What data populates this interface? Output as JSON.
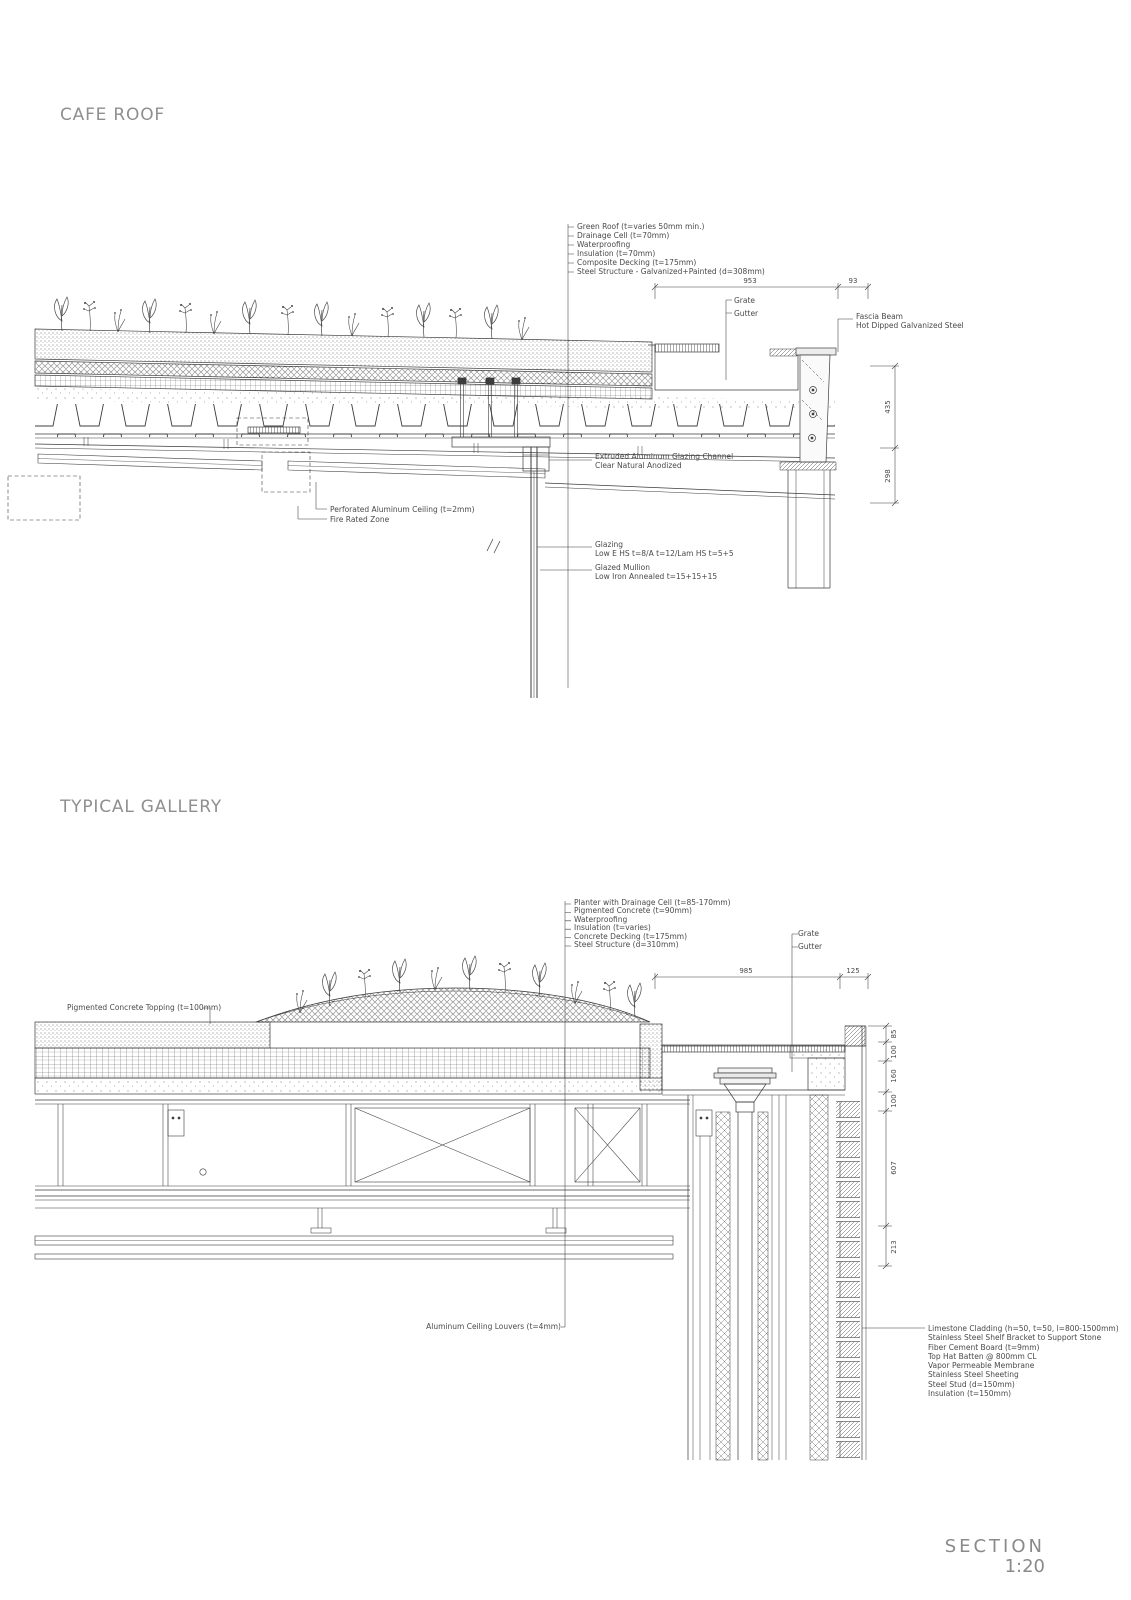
{
  "page": {
    "cafe_title": "CAFE ROOF",
    "gallery_title": "TYPICAL GALLERY",
    "section_label": "SECTION",
    "scale_label": "1:20"
  },
  "cafe_roof": {
    "layer_callouts": [
      "Green Roof (t=varies 50mm min.)",
      "Drainage Cell (t=70mm)",
      "Waterproofing",
      "Insulation (t=70mm)",
      "Composite Decking (t=175mm)",
      "Steel Structure - Galvanized+Painted (d=308mm)"
    ],
    "grate_label": "Grate",
    "gutter_label": "Gutter",
    "fascia_label_1": "Fascia Beam",
    "fascia_label_2": "Hot Dipped Galvanized Steel",
    "glazing_channel_1": "Extruded Aluminum Glazing Channel",
    "glazing_channel_2": "Clear Natural Anodized",
    "perforated_ceiling_label": "Perforated Aluminum Ceiling (t=2mm)",
    "fire_rated_label": "Fire Rated Zone",
    "glazing_1": "Glazing",
    "glazing_2": "Low E HS t=8/A t=12/Lam HS t=5+5",
    "mullion_1": "Glazed Mullion",
    "mullion_2": "Low Iron Annealed t=15+15+15",
    "dims": {
      "gutter_width": "953",
      "edge": "93",
      "upper_height": "435",
      "lower_height": "298"
    }
  },
  "typical_gallery": {
    "layer_callouts": [
      "Planter with Drainage Cell (t=85-170mm)",
      "Pigmented Concrete (t=90mm)",
      "Waterproofing",
      "Insulation (t=varies)",
      "Concrete Decking (t=175mm)",
      "Steel Structure (d=310mm)"
    ],
    "topping_label": "Pigmented Concrete Topping (t=100mm)",
    "grate_label": "Grate",
    "gutter_label": "Gutter",
    "louvers_label": "Aluminum Ceiling Louvers (t=4mm)",
    "wall_callouts": [
      "Limestone Cladding (h=50, t=50, l=800-1500mm)",
      "Stainless Steel Shelf Bracket to Support Stone",
      "Fiber Cement Board (t=9mm)",
      "Top Hat Batten @ 800mm CL",
      "Vapor Permeable Membrane",
      "Stainless Steel Sheeting",
      "Steel Stud (d=150mm)",
      "Insulation (t=150mm)"
    ],
    "dims": {
      "gutter_width": "985",
      "edge": "125",
      "right": [
        "85",
        "100",
        "160",
        "100",
        "607",
        "213"
      ]
    }
  }
}
